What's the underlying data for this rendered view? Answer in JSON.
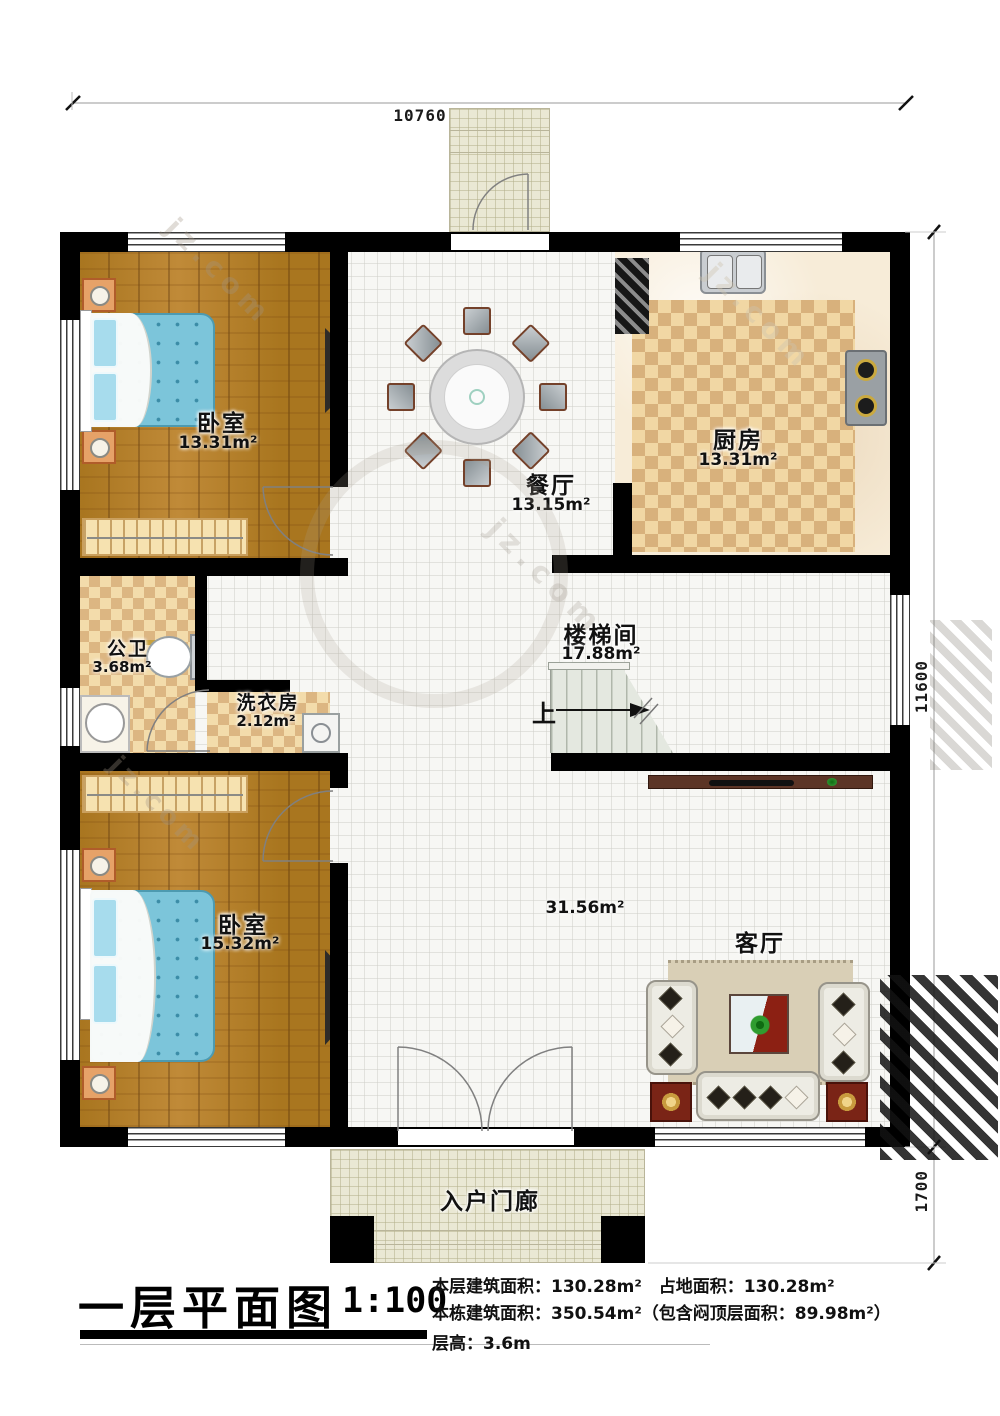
{
  "title_block": {
    "title": "一层平面图",
    "scale": "1:100",
    "line1": "本层建筑面积：130.28m²　占地面积：130.28m²",
    "line2": "本栋建筑面积：350.54m²（包含闷顶层面积：89.98m²）",
    "line3": "层高：3.6m"
  },
  "dimensions": {
    "top_width": "10760",
    "right_height": "11600",
    "porch_depth": "1700"
  },
  "rooms": [
    {
      "name": "卧室",
      "area": "13.31m²"
    },
    {
      "name": "餐厅",
      "area": "13.15m²"
    },
    {
      "name": "厨房",
      "area": "13.31m²"
    },
    {
      "name": "公卫",
      "area": "3.68m²"
    },
    {
      "name": "洗衣房",
      "area": "2.12m²"
    },
    {
      "name": "楼梯间",
      "area": "17.88m²"
    },
    {
      "name": "卧室",
      "area": "15.32m²"
    },
    {
      "name": "客厅",
      "area": "31.56m²"
    },
    {
      "name": "入户门廊"
    }
  ],
  "stairs": {
    "up_label": "上"
  },
  "watermark": {
    "fragment": "jz.com"
  }
}
